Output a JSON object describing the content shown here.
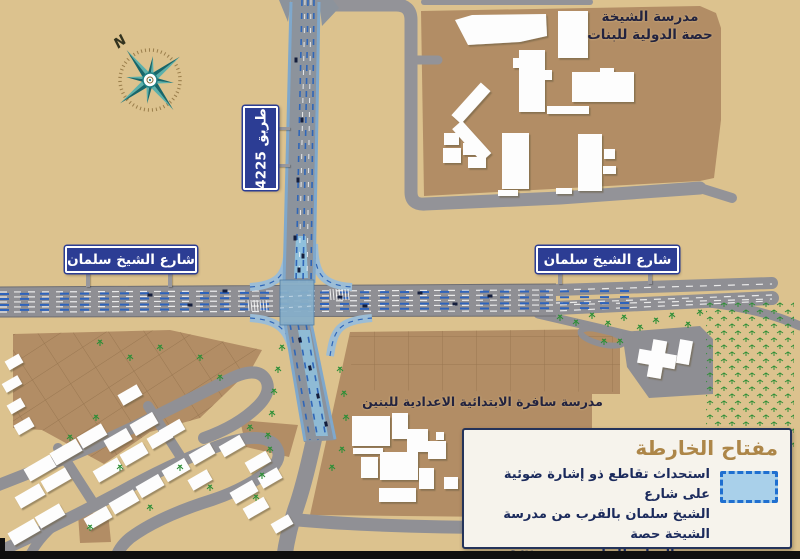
{
  "map": {
    "compass": {
      "north": "N"
    },
    "signs": {
      "sheikh_salman_left": "شارع الشيخ سلمان",
      "sheikh_salman_right": "شارع الشيخ سلمان",
      "road_4225": "طريق 4225"
    },
    "labels": {
      "girls_school_line1": "مدرسة الشيخة",
      "girls_school_line2": "حصة الدولية للبنات",
      "boys_school": "مدرسة سافرة الابتدائية الاعدادية للبنين"
    },
    "legend": {
      "title": "مفتاح الخارطة",
      "item": {
        "symbol": "dashed-blue-rectangle",
        "line1": "استحداث تقاطع ذو إشارة ضوئية على شارع",
        "line2": "الشيخ سلمان بالقرب من مدرسة الشيخة حصة",
        "line3": "الدولية للبنات – مجمع ٩٤٢"
      }
    },
    "colors": {
      "background": "#dcc28e",
      "parcel_brown": "#b28d65",
      "road_gray": "#8f8f94",
      "highlight_blue": "#86aec9",
      "lane_blue": "#2f66b8",
      "sign_blue": "#2c3d94",
      "legend_title": "#ad8648",
      "legend_text": "#1b2a5c",
      "tree_green": "#2e8f37"
    }
  }
}
